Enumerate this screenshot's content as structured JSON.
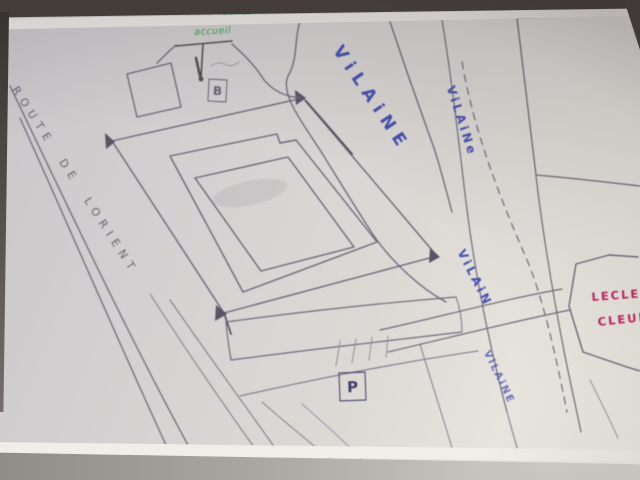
{
  "scene": {
    "type": "photograph of a hand-drawn street map sketch on paper",
    "colors": {
      "paper": "#dcd9d5",
      "pencil": "#6b6475",
      "blue_ink": "#4550ae",
      "green_ink": "#36a04c",
      "red_ink": "#c42261",
      "marker_ink": "#3d3b6b",
      "photo_border_top": "#46403c",
      "table_bottom": "#a9a7a1"
    }
  },
  "labels": {
    "road": "ROUTE DE LORIENT",
    "river_main": "ViLAiNE",
    "river_2": "ViLAiNe",
    "river_3": "ViLAiN",
    "river_4": "ViLAiNE",
    "green_note_line1": "Entrée Stade",
    "green_note_line2": "accueil",
    "store_line1": "LECLERC",
    "store_line2": "CLEUNAY",
    "marker_b": "B",
    "marker_p": "P"
  }
}
